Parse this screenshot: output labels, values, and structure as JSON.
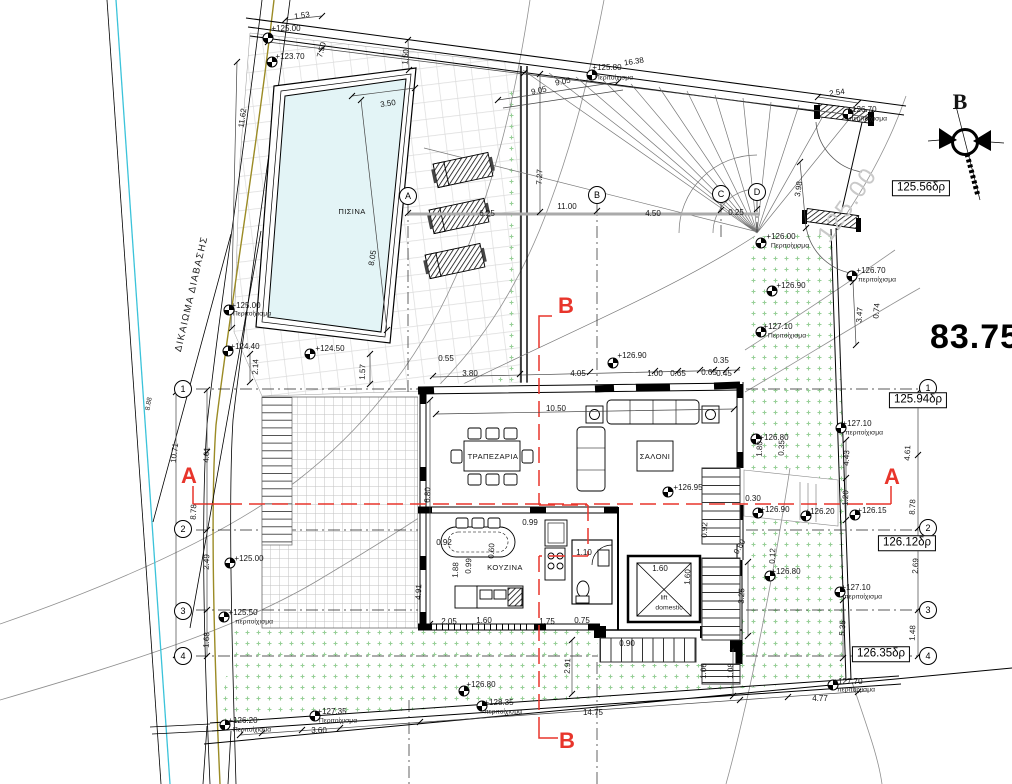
{
  "drawing": {
    "type": "architectural site / ground floor plan",
    "area_total": "83.75",
    "north_letter": "B",
    "rooms": {
      "pool": "ΠΙΣΙΝΑ",
      "dining": "ΤΡΑΠΕΖΑΡΙΑ",
      "living": "ΣΑΛΟΝΙ",
      "kitchen": "ΚΟΥΖΙΝΑ",
      "lift_line1": "lift",
      "lift_line2": "domestic"
    },
    "colors": {
      "section_red": "#e8352b",
      "water": "#e3f4f6",
      "grass_dot": "#97cf97",
      "boundary_cyan": "#3bc3da",
      "utility_olive": "#9b8b25"
    }
  },
  "road_level_boxes": [
    {
      "n": "box-125-56",
      "t": "125.56δρ",
      "x": 921,
      "y": 188
    },
    {
      "n": "box-125-94",
      "t": "125.94δρ",
      "x": 918,
      "y": 400
    },
    {
      "n": "box-126-12",
      "t": "126.12δρ",
      "x": 907,
      "y": 543
    },
    {
      "n": "box-126-35",
      "t": "126.35δρ",
      "x": 881,
      "y": 654
    }
  ],
  "grid_bubbles": [
    {
      "l": "A",
      "x": 408,
      "y": 196
    },
    {
      "l": "B",
      "x": 597,
      "y": 195
    },
    {
      "l": "C",
      "x": 721,
      "y": 194
    },
    {
      "l": "D",
      "x": 757,
      "y": 192
    },
    {
      "l": "1",
      "x": 183,
      "y": 389
    },
    {
      "l": "2",
      "x": 183,
      "y": 529
    },
    {
      "l": "3",
      "x": 183,
      "y": 611
    },
    {
      "l": "4",
      "x": 183,
      "y": 656
    },
    {
      "l": "1",
      "x": 928,
      "y": 388
    },
    {
      "l": "2",
      "x": 928,
      "y": 528
    },
    {
      "l": "3",
      "x": 928,
      "y": 610
    },
    {
      "l": "4",
      "x": 928,
      "y": 656
    }
  ],
  "benchmark_points": [
    [
      268,
      38
    ],
    [
      272,
      62
    ],
    [
      310,
      354
    ],
    [
      229,
      310
    ],
    [
      228,
      351
    ],
    [
      592,
      75
    ],
    [
      761,
      243
    ],
    [
      848,
      114
    ],
    [
      852,
      276
    ],
    [
      772,
      291
    ],
    [
      761,
      332
    ],
    [
      613,
      363
    ],
    [
      668,
      492
    ],
    [
      230,
      563
    ],
    [
      224,
      617
    ],
    [
      756,
      439
    ],
    [
      758,
      513
    ],
    [
      806,
      516
    ],
    [
      855,
      515
    ],
    [
      770,
      576
    ],
    [
      841,
      428
    ],
    [
      840,
      592
    ],
    [
      464,
      691
    ],
    [
      482,
      706
    ],
    [
      225,
      725
    ],
    [
      315,
      716
    ],
    [
      833,
      685
    ]
  ],
  "labels": [
    {
      "n": "dim-1-53",
      "t": "1.53",
      "x": 302,
      "y": 16,
      "r": -8
    },
    {
      "n": "elev-125-00-top",
      "t": "+125.00",
      "x": 286,
      "y": 29,
      "c": "c-elev"
    },
    {
      "n": "dim-7-50",
      "t": "7.50",
      "x": 322,
      "y": 50,
      "r": -75
    },
    {
      "n": "elev-123-70",
      "t": "+123.70",
      "x": 290,
      "y": 57,
      "c": "c-elev"
    },
    {
      "n": "dim-11-62",
      "t": "11.62",
      "x": 243,
      "y": 118,
      "r": -82
    },
    {
      "n": "dim-3-50",
      "t": "3.50",
      "x": 388,
      "y": 104,
      "r": -8
    },
    {
      "n": "dim-1-50",
      "t": "1.50",
      "x": 406,
      "y": 57,
      "r": -85
    },
    {
      "n": "room-pool",
      "t": "ΠΙΣΙΝΑ",
      "x": 352,
      "y": 212,
      "c": "c-room"
    },
    {
      "n": "dim-8-05",
      "t": "8.05",
      "x": 373,
      "y": 258,
      "r": -80
    },
    {
      "n": "elev-124-50",
      "t": "+124.50",
      "x": 330,
      "y": 349,
      "c": "c-elev"
    },
    {
      "n": "elev-125-00-left",
      "t": "+125.00",
      "x": 246,
      "y": 306,
      "c": "c-elev"
    },
    {
      "n": "wall-note-1",
      "t": "Περιτοίχισμα",
      "x": 252,
      "y": 315,
      "c": "c-sm"
    },
    {
      "n": "elev-124-40",
      "t": "+124.40",
      "x": 245,
      "y": 347,
      "c": "c-elev"
    },
    {
      "n": "dim-2-14",
      "t": "2.14",
      "x": 256,
      "y": 367,
      "r": -87
    },
    {
      "n": "dim-1-57",
      "t": "1.57",
      "x": 363,
      "y": 372,
      "r": -87
    },
    {
      "n": "right-of-way",
      "t": "ΔΙΚΑΙΩΜΑ ΔΙΑΒΑΣΗΣ",
      "x": 192,
      "y": 294,
      "r": -77,
      "c": "c-row"
    },
    {
      "n": "dim-8-88",
      "t": "8.88",
      "x": 150,
      "y": 404,
      "r": -80,
      "c": "c-sm"
    },
    {
      "n": "elev-125-80",
      "t": "+125.80",
      "x": 607,
      "y": 68,
      "c": "c-elev"
    },
    {
      "n": "wall-note-2",
      "t": "Περιτοίχισμα",
      "x": 614,
      "y": 79,
      "c": "c-sm"
    },
    {
      "n": "dim-16-38",
      "t": "16.38",
      "x": 634,
      "y": 62,
      "r": -9
    },
    {
      "n": "dim-9-05-a",
      "t": "9.05",
      "x": 563,
      "y": 82,
      "r": -12
    },
    {
      "n": "dim-9-05-b",
      "t": "9.05",
      "x": 539,
      "y": 91,
      "r": -12
    },
    {
      "n": "dim-7-27",
      "t": "7.27",
      "x": 540,
      "y": 177,
      "r": -87
    },
    {
      "n": "dim-11-00",
      "t": "11.00",
      "x": 567,
      "y": 207
    },
    {
      "n": "dim-4-50",
      "t": "4.50",
      "x": 653,
      "y": 214
    },
    {
      "n": "dim-0-25",
      "t": "0.25",
      "x": 736,
      "y": 213
    },
    {
      "n": "dim-6-25",
      "t": "6.25",
      "x": 487,
      "y": 214
    },
    {
      "n": "dim-3-98",
      "t": "3.98",
      "x": 799,
      "y": 189,
      "r": -82
    },
    {
      "n": "dim-2-54",
      "t": "2.54",
      "x": 837,
      "y": 93,
      "r": -8
    },
    {
      "n": "elev-126-70-top",
      "t": "+126.70",
      "x": 862,
      "y": 110,
      "c": "c-elev"
    },
    {
      "n": "wall-note-3",
      "t": "περιτοίχισμα",
      "x": 868,
      "y": 120,
      "c": "c-sm"
    },
    {
      "n": "north-label",
      "t": "B",
      "x": 960,
      "y": 102,
      "c": "c-north"
    },
    {
      "n": "contour-label",
      "t": "125.00",
      "x": 848,
      "y": 205,
      "r": -55,
      "c": "c-ghost"
    },
    {
      "n": "area-total",
      "t": "83.75",
      "x": 975,
      "y": 337,
      "c": "c-big"
    },
    {
      "n": "elev-126-00",
      "t": "+126.00",
      "x": 781,
      "y": 237,
      "c": "c-elev"
    },
    {
      "n": "wall-note-4",
      "t": "Περιτοίχισμα",
      "x": 790,
      "y": 247,
      "c": "c-sm"
    },
    {
      "n": "elev-126-70-right",
      "t": "+126.70",
      "x": 871,
      "y": 271,
      "c": "c-elev"
    },
    {
      "n": "wall-note-5",
      "t": "περιτοίχισμα",
      "x": 877,
      "y": 281,
      "c": "c-sm"
    },
    {
      "n": "elev-126-90-right",
      "t": "+126.90",
      "x": 791,
      "y": 286,
      "c": "c-elev"
    },
    {
      "n": "elev-127-10-right",
      "t": "+127.10",
      "x": 778,
      "y": 327,
      "c": "c-elev"
    },
    {
      "n": "wall-note-6",
      "t": "Περιτοίχισμα",
      "x": 787,
      "y": 337,
      "c": "c-sm"
    },
    {
      "n": "dim-3-47",
      "t": "3.47",
      "x": 860,
      "y": 315,
      "r": -85
    },
    {
      "n": "dim-0-74",
      "t": "0.74",
      "x": 877,
      "y": 311,
      "r": -85
    },
    {
      "n": "dim-0-55",
      "t": "0.55",
      "x": 446,
      "y": 359
    },
    {
      "n": "dim-3-80",
      "t": "3.80",
      "x": 470,
      "y": 374
    },
    {
      "n": "dim-4-05",
      "t": "4.05",
      "x": 578,
      "y": 374
    },
    {
      "n": "elev-126-90-mid",
      "t": "+126.90",
      "x": 632,
      "y": 356,
      "c": "c-elev"
    },
    {
      "n": "dim-1-00",
      "t": "1.00",
      "x": 655,
      "y": 374
    },
    {
      "n": "dim-0-65-a",
      "t": "0.65",
      "x": 678,
      "y": 374
    },
    {
      "n": "dim-0-65-b",
      "t": "0.65",
      "x": 709,
      "y": 373
    },
    {
      "n": "dim-0-45",
      "t": "0.45",
      "x": 724,
      "y": 374
    },
    {
      "n": "dim-0-35-a",
      "t": "0.35",
      "x": 721,
      "y": 361
    },
    {
      "n": "dim-10-71",
      "t": "10.71",
      "x": 175,
      "y": 453,
      "r": -83
    },
    {
      "n": "dim-4-61-left",
      "t": "4.61",
      "x": 207,
      "y": 455,
      "r": -87
    },
    {
      "n": "dim-8-78-left",
      "t": "8.78",
      "x": 194,
      "y": 512,
      "r": -87
    },
    {
      "n": "section-a-left",
      "t": "A",
      "x": 189,
      "y": 476,
      "c": "c-red"
    },
    {
      "n": "dim-2-49",
      "t": "2.49",
      "x": 207,
      "y": 562,
      "r": -87
    },
    {
      "n": "elev-125-00-mid",
      "t": "+125.00",
      "x": 249,
      "y": 559,
      "c": "c-elev"
    },
    {
      "n": "elev-125-50",
      "t": "+125.50",
      "x": 243,
      "y": 613,
      "c": "c-elev"
    },
    {
      "n": "wall-note-7",
      "t": "περιτοίχισμα",
      "x": 254,
      "y": 623,
      "c": "c-sm"
    },
    {
      "n": "dim-1-68",
      "t": "1.68",
      "x": 207,
      "y": 640,
      "r": -87
    },
    {
      "n": "dim-10-50",
      "t": "10.50",
      "x": 556,
      "y": 409
    },
    {
      "n": "room-dining",
      "t": "ΤΡΑΠΕΖΑΡΙΑ",
      "x": 493,
      "y": 457,
      "c": "c-room"
    },
    {
      "n": "room-living",
      "t": "ΣΑΛΟΝΙ",
      "x": 655,
      "y": 457,
      "c": "c-room"
    },
    {
      "n": "elev-126-95",
      "t": "+126.95",
      "x": 688,
      "y": 488,
      "c": "c-elev"
    },
    {
      "n": "dim-6-80",
      "t": "6.80",
      "x": 428,
      "y": 495,
      "r": -87
    },
    {
      "n": "room-kitchen",
      "t": "ΚΟΥΖΙΝΑ",
      "x": 505,
      "y": 568,
      "c": "c-room"
    },
    {
      "n": "dim-0-92-a",
      "t": "0.92",
      "x": 444,
      "y": 543
    },
    {
      "n": "dim-0-99-a",
      "t": "0.99",
      "x": 530,
      "y": 523
    },
    {
      "n": "dim-0-99-b",
      "t": "0.99",
      "x": 469,
      "y": 566,
      "r": -87
    },
    {
      "n": "dim-1-88",
      "t": "1.88",
      "x": 456,
      "y": 570,
      "r": -87
    },
    {
      "n": "dim-1-10",
      "t": "1.10",
      "x": 584,
      "y": 553
    },
    {
      "n": "dim-0-60",
      "t": "0.60",
      "x": 492,
      "y": 551,
      "r": -87
    },
    {
      "n": "dim-4-91",
      "t": "4.91",
      "x": 419,
      "y": 592,
      "r": -87
    },
    {
      "n": "dim-1-60-lift-a",
      "t": "1.60",
      "x": 660,
      "y": 569
    },
    {
      "n": "dim-1-60-lift-b",
      "t": "1.60",
      "x": 688,
      "y": 577,
      "r": -87
    },
    {
      "n": "lift-label-1",
      "t": "lift",
      "x": 664,
      "y": 599,
      "c": "c-sm"
    },
    {
      "n": "lift-label-2",
      "t": "domestic",
      "x": 669,
      "y": 609,
      "c": "c-sm"
    },
    {
      "n": "dim-2-05",
      "t": "2.05",
      "x": 449,
      "y": 622
    },
    {
      "n": "dim-1-60-b",
      "t": "1.60",
      "x": 484,
      "y": 621
    },
    {
      "n": "dim-1-75",
      "t": "1.75",
      "x": 547,
      "y": 622
    },
    {
      "n": "dim-0-75",
      "t": "0.75",
      "x": 582,
      "y": 621
    },
    {
      "n": "dim-0-90",
      "t": "0.90",
      "x": 627,
      "y": 644
    },
    {
      "n": "elev-126-80-stair",
      "t": "+126.80",
      "x": 774,
      "y": 438,
      "c": "c-elev"
    },
    {
      "n": "dim-1-80",
      "t": "1.80",
      "x": 760,
      "y": 449,
      "r": -87
    },
    {
      "n": "dim-0-35-b",
      "t": "0.35",
      "x": 782,
      "y": 448,
      "r": -87
    },
    {
      "n": "dim-4-43",
      "t": "4.43",
      "x": 847,
      "y": 458,
      "r": -87
    },
    {
      "n": "dim-1-20",
      "t": "1.20",
      "x": 846,
      "y": 498,
      "r": -87
    },
    {
      "n": "dim-0-30",
      "t": "0.30",
      "x": 753,
      "y": 499
    },
    {
      "n": "elev-126-90-stair",
      "t": "+126.90",
      "x": 775,
      "y": 510,
      "c": "c-elev"
    },
    {
      "n": "elev-126-20-gate",
      "t": "+126.20",
      "x": 820,
      "y": 512,
      "c": "c-elev"
    },
    {
      "n": "elev-126-15",
      "t": "+126.15",
      "x": 872,
      "y": 511,
      "c": "c-elev"
    },
    {
      "n": "dim-0-92-b",
      "t": "0.92",
      "x": 705,
      "y": 530,
      "r": -87
    },
    {
      "n": "dim-0-80",
      "t": "0.80",
      "x": 740,
      "y": 547,
      "r": -60
    },
    {
      "n": "dim-0-12",
      "t": "0.12",
      "x": 773,
      "y": 556,
      "r": -87
    },
    {
      "n": "elev-126-80-lower",
      "t": "+126.80",
      "x": 786,
      "y": 572,
      "c": "c-elev"
    },
    {
      "n": "dim-3-25",
      "t": "3.25",
      "x": 742,
      "y": 596,
      "r": -87
    },
    {
      "n": "elev-127-10-ur",
      "t": "+127.10",
      "x": 857,
      "y": 424,
      "c": "c-elev"
    },
    {
      "n": "wall-note-8",
      "t": "περιτοίχισμα",
      "x": 864,
      "y": 434,
      "c": "c-sm"
    },
    {
      "n": "elev-127-10-lr",
      "t": "+127.10",
      "x": 856,
      "y": 588,
      "c": "c-elev"
    },
    {
      "n": "wall-note-9",
      "t": "περιτοίχισμα",
      "x": 863,
      "y": 598,
      "c": "c-sm"
    },
    {
      "n": "dim-5-35",
      "t": "5.35",
      "x": 843,
      "y": 628,
      "r": -87
    },
    {
      "n": "dim-4-61-right",
      "t": "4.61",
      "x": 908,
      "y": 453,
      "r": -87
    },
    {
      "n": "dim-8-78-right",
      "t": "8.78",
      "x": 913,
      "y": 507,
      "r": -87
    },
    {
      "n": "section-a-right",
      "t": "A",
      "x": 892,
      "y": 477,
      "c": "c-red"
    },
    {
      "n": "dim-2-69",
      "t": "2.69",
      "x": 916,
      "y": 566,
      "r": -87
    },
    {
      "n": "dim-1-48",
      "t": "1.48",
      "x": 913,
      "y": 633,
      "r": -87
    },
    {
      "n": "dim-2-91",
      "t": "2.91",
      "x": 568,
      "y": 666,
      "r": -87
    },
    {
      "n": "elev-126-80-bottom",
      "t": "+126.80",
      "x": 481,
      "y": 685,
      "c": "c-elev"
    },
    {
      "n": "elev-128-35",
      "t": "+128.35",
      "x": 499,
      "y": 703,
      "c": "c-elev"
    },
    {
      "n": "wall-note-10",
      "t": "περιτοίχισμα",
      "x": 503,
      "y": 713,
      "c": "c-sm"
    },
    {
      "n": "dim-14-75",
      "t": "14.75",
      "x": 593,
      "y": 713
    },
    {
      "n": "section-b-top",
      "t": "B",
      "x": 566,
      "y": 306,
      "c": "c-red"
    },
    {
      "n": "section-b-bottom",
      "t": "B",
      "x": 567,
      "y": 741,
      "c": "c-red"
    },
    {
      "n": "elev-126-20-bl",
      "t": "+126.20",
      "x": 243,
      "y": 721,
      "c": "c-elev"
    },
    {
      "n": "wall-note-11",
      "t": "Περιτοίχισμα",
      "x": 252,
      "y": 731,
      "c": "c-sm"
    },
    {
      "n": "elev-127-35",
      "t": "+127.35",
      "x": 332,
      "y": 712,
      "c": "c-elev"
    },
    {
      "n": "wall-note-12",
      "t": "Περιτοίχισμα",
      "x": 338,
      "y": 722,
      "c": "c-sm"
    },
    {
      "n": "dim-3-60",
      "t": "3.60",
      "x": 319,
      "y": 731
    },
    {
      "n": "elev-127-70",
      "t": "+127.70",
      "x": 848,
      "y": 682,
      "c": "c-elev"
    },
    {
      "n": "wall-note-13",
      "t": "περιτοίχισμα",
      "x": 856,
      "y": 691,
      "c": "c-sm"
    },
    {
      "n": "dim-4-77",
      "t": "4.77",
      "x": 820,
      "y": 699
    },
    {
      "n": "dim-1-08",
      "t": "1.08",
      "x": 731,
      "y": 671,
      "r": -87
    },
    {
      "n": "dim-1-06",
      "t": "1.06",
      "x": 704,
      "y": 671,
      "r": -87
    }
  ]
}
